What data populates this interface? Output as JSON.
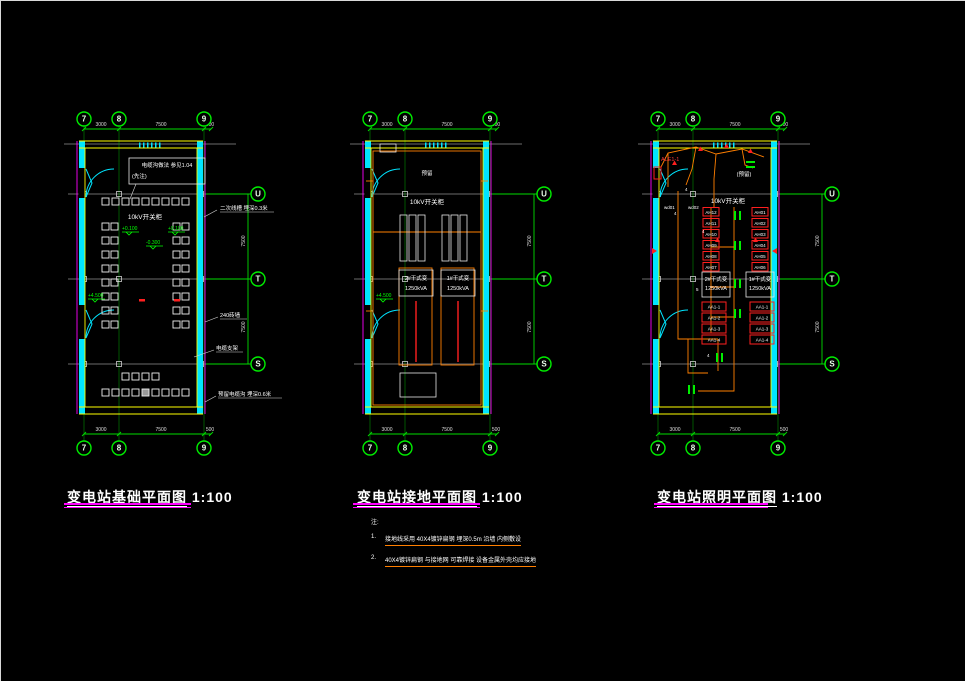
{
  "titles": {
    "t1": {
      "name": "变电站基础平面图",
      "scale": "1:100"
    },
    "t2": {
      "name": "变电站接地平面图",
      "scale": "1:100"
    },
    "t3": {
      "name": "变电站照明平面图",
      "scale": "1:100"
    }
  },
  "notes": {
    "header": "注:",
    "items": [
      {
        "no": "1.",
        "text": "接地线采用 40X4镀锌扁钢 埋深0.5m 沿墙 内侧敷设"
      },
      {
        "no": "2.",
        "text": "40X4镀锌扁钢 与接地网 可靠焊接 设备金属外壳均应接地"
      }
    ]
  },
  "axes": {
    "n7": "7",
    "n8": "8",
    "n9": "9",
    "lu": "U",
    "lt": "T",
    "ls": "S",
    "d1": "3000",
    "d2": "7500",
    "d3": "500",
    "dv": "7500"
  },
  "plan1": {
    "cable_box_line1": "电缆沟做法 参见1.04",
    "cable_box_line2": "(先注)",
    "switchgear": "10kV开关柜",
    "elev1": "+0.100",
    "elev2": "-0.300",
    "elev3": "+4.500",
    "elev4": "+0.100",
    "leader_top": "二次线槽 埋深0.3米",
    "leader_mid": "240砖墙",
    "leader_low": "电缆支架",
    "leader_bottom": "预留电缆沟 埋深0.6米"
  },
  "plan2": {
    "switchgear": "10kV开关柜",
    "reserved": "预留",
    "elev": "+4.500",
    "tx2_line1": "2#干式变",
    "tx2_line2": "1250kVA",
    "tx1_line1": "1#干式变",
    "tx1_line2": "1250kVA"
  },
  "plan3": {
    "panel": "ALE1-1",
    "reserved": "(预留)",
    "switchgear": "10kV开关柜",
    "wd1": "wd01",
    "wd2": "wd02",
    "w4": "4",
    "w5": "5",
    "ah_left": [
      "AH12",
      "AH11",
      "AH10",
      "AH09",
      "AH08",
      "AH07"
    ],
    "ah_right": [
      "AH01",
      "AH02",
      "AH03",
      "AH04",
      "AH05",
      "AH06"
    ],
    "aa_left": [
      "AA1-1",
      "AA1-2",
      "AA1-3",
      "AA1-4"
    ],
    "aa_right": [
      "AA1-1",
      "AA1-2",
      "AA1-3",
      "AA1-4"
    ],
    "tx2_line1": "2#干式变",
    "tx2_line2": "1250kVA",
    "tx1_line1": "1#干式变",
    "tx1_line2": "1250kVA"
  }
}
